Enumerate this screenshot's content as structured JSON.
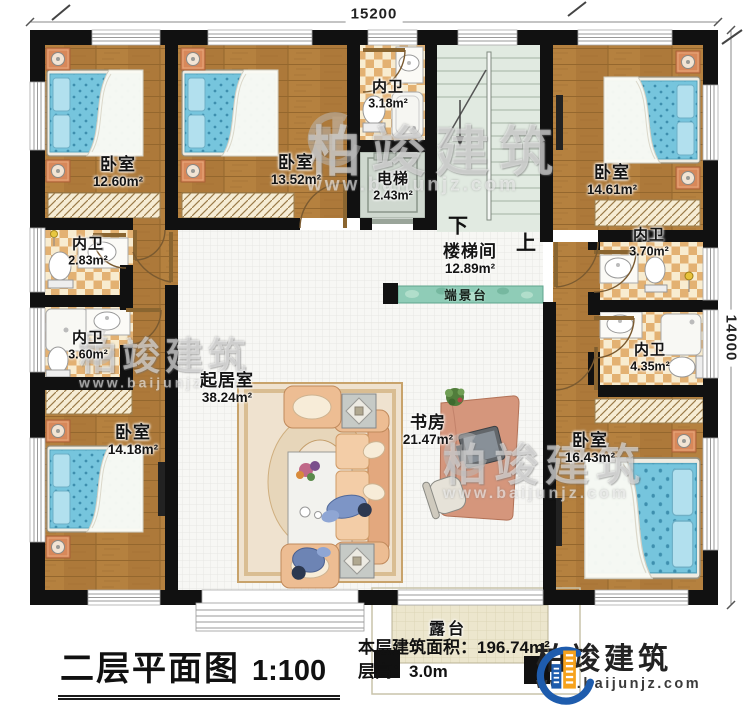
{
  "dimensions": {
    "top": "15200",
    "right": "14000"
  },
  "rooms": {
    "bedroom_top_left": {
      "name": "卧室",
      "area": "12.60m²"
    },
    "bedroom_top_mid": {
      "name": "卧室",
      "area": "13.52m²"
    },
    "bath_top": {
      "name": "内卫",
      "area": "3.18m²"
    },
    "elevator": {
      "name": "电梯",
      "area": "2.43m²"
    },
    "bedroom_top_right": {
      "name": "卧室",
      "area": "14.61m²"
    },
    "stairwell": {
      "name": "楼梯间",
      "area": "12.89m²"
    },
    "bath_left_upper": {
      "name": "内卫",
      "area": "2.83m²"
    },
    "bath_left_lower": {
      "name": "内卫",
      "area": "3.60m²"
    },
    "bath_right_upper": {
      "name": "内卫",
      "area": "3.70m²"
    },
    "bath_right_lower": {
      "name": "内卫",
      "area": "4.35m²"
    },
    "living_room": {
      "name": "起居室",
      "area": "38.24m²"
    },
    "study": {
      "name": "书房",
      "area": "21.47m²"
    },
    "bedroom_bottom_left": {
      "name": "卧室",
      "area": "14.18m²"
    },
    "bedroom_bottom_right": {
      "name": "卧室",
      "area": "16.43m²"
    },
    "console_table": {
      "name": "端景台"
    },
    "terrace": {
      "name": "露台"
    }
  },
  "stairs": {
    "down_label": "下",
    "up_label": "上"
  },
  "title_block": {
    "title": "二层平面图",
    "scale": "1:100",
    "floor_area_label": "本层建筑面积：",
    "floor_area_value": "196.74m²",
    "floor_height_label": "层高：",
    "floor_height_value": "3.0m"
  },
  "brand": {
    "name": "柏竣建筑",
    "website": "www.baijunjz.com"
  },
  "watermark": {
    "name": "柏竣建筑",
    "website": "www.baijunjz.com"
  },
  "colors": {
    "wall": "#111111",
    "wood_floor": "#b5813f",
    "tile_floor": "#f8ecd0",
    "tile_check": "#e3b172",
    "living_floor": "#f7f7f4",
    "stair_floor": "#e1eae1",
    "elevator": "#cfd8cf",
    "console_table": "#8fccb7",
    "terrace": "#ece6cd",
    "bed": "#76c5dd",
    "sofa": "#edbd93",
    "desk": "#d5967c",
    "logo_blue": "#1e5cad",
    "logo_orange": "#f6a21c"
  }
}
